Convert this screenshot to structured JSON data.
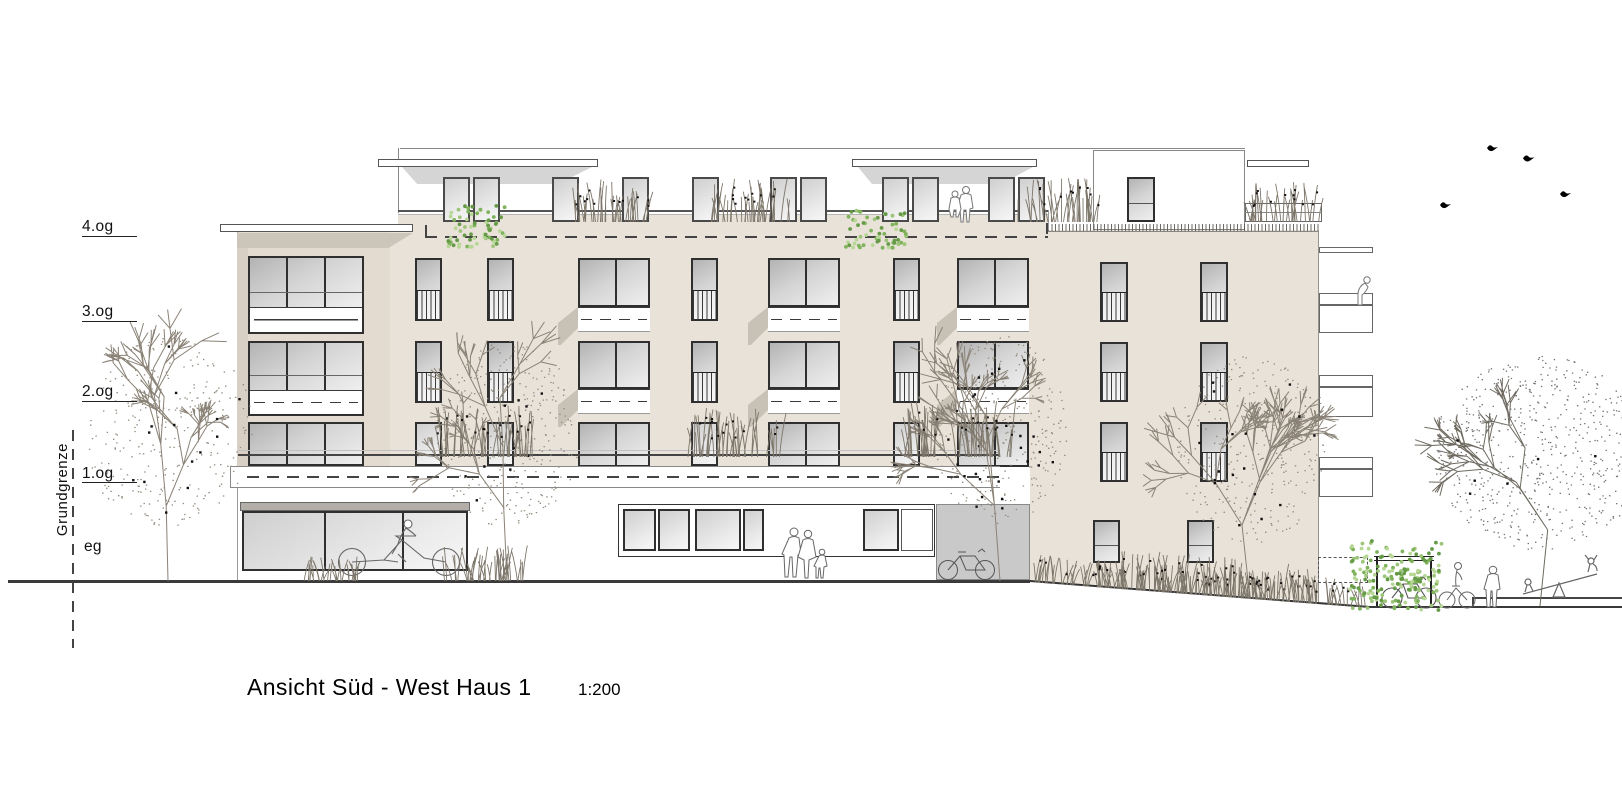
{
  "drawing": {
    "title": "Ansicht Süd - West  Haus 1",
    "scale": "1:200",
    "boundary_label": "Grundgrenze",
    "levels": [
      {
        "label": "4.og"
      },
      {
        "label": "3.og"
      },
      {
        "label": "2.og"
      },
      {
        "label": "1.og"
      },
      {
        "label": "eg"
      }
    ]
  },
  "colors": {
    "facade": "#e9e2d8",
    "wing": "#e3dbd0",
    "shadow_beige": "#ccc5ba",
    "shadow_gray": "#d5d5d5",
    "frame": "#2f2f2f",
    "gray_panel": "#c9c9c9",
    "storefront_bar": "#b3afa8",
    "green_1": "#9cc57a",
    "green_2": "#7fb35b",
    "green_3": "#b7d796",
    "tree_line": "#8a8276"
  },
  "building": {
    "windows": [
      {
        "x": 415,
        "y": 258,
        "w": 27,
        "h": 63,
        "t": "nb"
      },
      {
        "x": 487,
        "y": 258,
        "w": 27,
        "h": 63,
        "t": "nb"
      },
      {
        "x": 691,
        "y": 258,
        "w": 27,
        "h": 63,
        "t": "nb"
      },
      {
        "x": 893,
        "y": 258,
        "w": 27,
        "h": 63,
        "t": "nb"
      },
      {
        "x": 1100,
        "y": 262,
        "w": 28,
        "h": 60,
        "t": "nb"
      },
      {
        "x": 1200,
        "y": 262,
        "w": 28,
        "h": 60,
        "t": "nb"
      },
      {
        "x": 578,
        "y": 258,
        "w": 72,
        "h": 74,
        "t": "wide"
      },
      {
        "x": 768,
        "y": 258,
        "w": 72,
        "h": 74,
        "t": "wide"
      },
      {
        "x": 957,
        "y": 258,
        "w": 72,
        "h": 74,
        "t": "wide"
      },
      {
        "x": 415,
        "y": 341,
        "w": 27,
        "h": 62,
        "t": "nb"
      },
      {
        "x": 487,
        "y": 341,
        "w": 27,
        "h": 62,
        "t": "nb"
      },
      {
        "x": 691,
        "y": 341,
        "w": 27,
        "h": 62,
        "t": "nb"
      },
      {
        "x": 893,
        "y": 341,
        "w": 27,
        "h": 62,
        "t": "nb"
      },
      {
        "x": 1100,
        "y": 342,
        "w": 28,
        "h": 60,
        "t": "nb"
      },
      {
        "x": 1200,
        "y": 342,
        "w": 28,
        "h": 60,
        "t": "nb"
      },
      {
        "x": 578,
        "y": 341,
        "w": 72,
        "h": 73,
        "t": "wide"
      },
      {
        "x": 768,
        "y": 341,
        "w": 72,
        "h": 73,
        "t": "wide"
      },
      {
        "x": 957,
        "y": 341,
        "w": 72,
        "h": 73,
        "t": "wide"
      },
      {
        "x": 415,
        "y": 422,
        "w": 27,
        "h": 44,
        "t": "door"
      },
      {
        "x": 487,
        "y": 422,
        "w": 27,
        "h": 44,
        "t": "door"
      },
      {
        "x": 691,
        "y": 422,
        "w": 27,
        "h": 44,
        "t": "door"
      },
      {
        "x": 893,
        "y": 422,
        "w": 27,
        "h": 44,
        "t": "door"
      },
      {
        "x": 578,
        "y": 422,
        "w": 72,
        "h": 45,
        "t": "dwide"
      },
      {
        "x": 768,
        "y": 422,
        "w": 72,
        "h": 45,
        "t": "dwide"
      },
      {
        "x": 957,
        "y": 422,
        "w": 72,
        "h": 45,
        "t": "dwide"
      },
      {
        "x": 1100,
        "y": 422,
        "w": 28,
        "h": 60,
        "t": "nb"
      },
      {
        "x": 1200,
        "y": 422,
        "w": 28,
        "h": 60,
        "t": "nb"
      },
      {
        "x": 1093,
        "y": 520,
        "w": 27,
        "h": 43,
        "t": "plain"
      },
      {
        "x": 1187,
        "y": 520,
        "w": 27,
        "h": 43,
        "t": "plain"
      },
      {
        "x": 1127,
        "y": 177,
        "w": 28,
        "h": 45,
        "t": "plain"
      }
    ],
    "penthouse_door_xs": [
      443,
      473,
      552,
      622,
      692,
      770,
      800,
      882,
      912,
      988,
      1018
    ]
  },
  "vegetation": {
    "trees": [
      {
        "x": 168,
        "baseY": 581,
        "h": 250,
        "spread": 175,
        "kind": "winter",
        "seed": 7,
        "flecks": 14
      },
      {
        "x": 507,
        "baseY": 581,
        "h": 245,
        "spread": 145,
        "kind": "winter",
        "seed": 13,
        "flecks": 12
      },
      {
        "x": 1000,
        "baseY": 581,
        "h": 252,
        "spread": 135,
        "kind": "winter",
        "seed": 21,
        "flecks": 26
      },
      {
        "x": 1250,
        "baseY": 599,
        "h": 248,
        "spread": 150,
        "kind": "winter",
        "seed": 31,
        "flecks": 18
      },
      {
        "x": 1540,
        "baseY": 606,
        "h": 255,
        "spread": 215,
        "kind": "dotted",
        "seed": 43,
        "flecks": 6
      }
    ],
    "grass": [
      {
        "x": 575,
        "y": 178,
        "w": 75,
        "h": 44,
        "kind": "reed",
        "seed": 3
      },
      {
        "x": 710,
        "y": 178,
        "w": 80,
        "h": 44,
        "kind": "reed",
        "seed": 4
      },
      {
        "x": 1018,
        "y": 176,
        "w": 80,
        "h": 46,
        "kind": "reed",
        "seed": 5
      },
      {
        "x": 1250,
        "y": 181,
        "w": 70,
        "h": 41,
        "kind": "reed",
        "seed": 6
      },
      {
        "x": 438,
        "y": 405,
        "w": 95,
        "h": 52,
        "kind": "reed",
        "seed": 8
      },
      {
        "x": 688,
        "y": 408,
        "w": 92,
        "h": 49,
        "kind": "reed",
        "seed": 9
      },
      {
        "x": 903,
        "y": 398,
        "w": 108,
        "h": 59,
        "kind": "reed",
        "seed": 10
      },
      {
        "x": 443,
        "y": 545,
        "w": 92,
        "h": 36,
        "kind": "grass",
        "seed": 11
      },
      {
        "x": 300,
        "y": 556,
        "w": 60,
        "h": 25,
        "kind": "grass",
        "seed": 12
      },
      {
        "x": 1035,
        "y": 552,
        "w": 332,
        "h": 28,
        "kind": "slope",
        "seed": 14
      },
      {
        "x": 1120,
        "y": 560,
        "w": 200,
        "h": 40,
        "kind": "slope",
        "seed": 15
      }
    ],
    "green": [
      {
        "x": 448,
        "y": 203,
        "w": 58,
        "h": 44,
        "seed": 17
      },
      {
        "x": 845,
        "y": 210,
        "w": 62,
        "h": 38,
        "seed": 18
      },
      {
        "x": 1350,
        "y": 536,
        "w": 92,
        "h": 74,
        "seed": 19
      }
    ]
  }
}
